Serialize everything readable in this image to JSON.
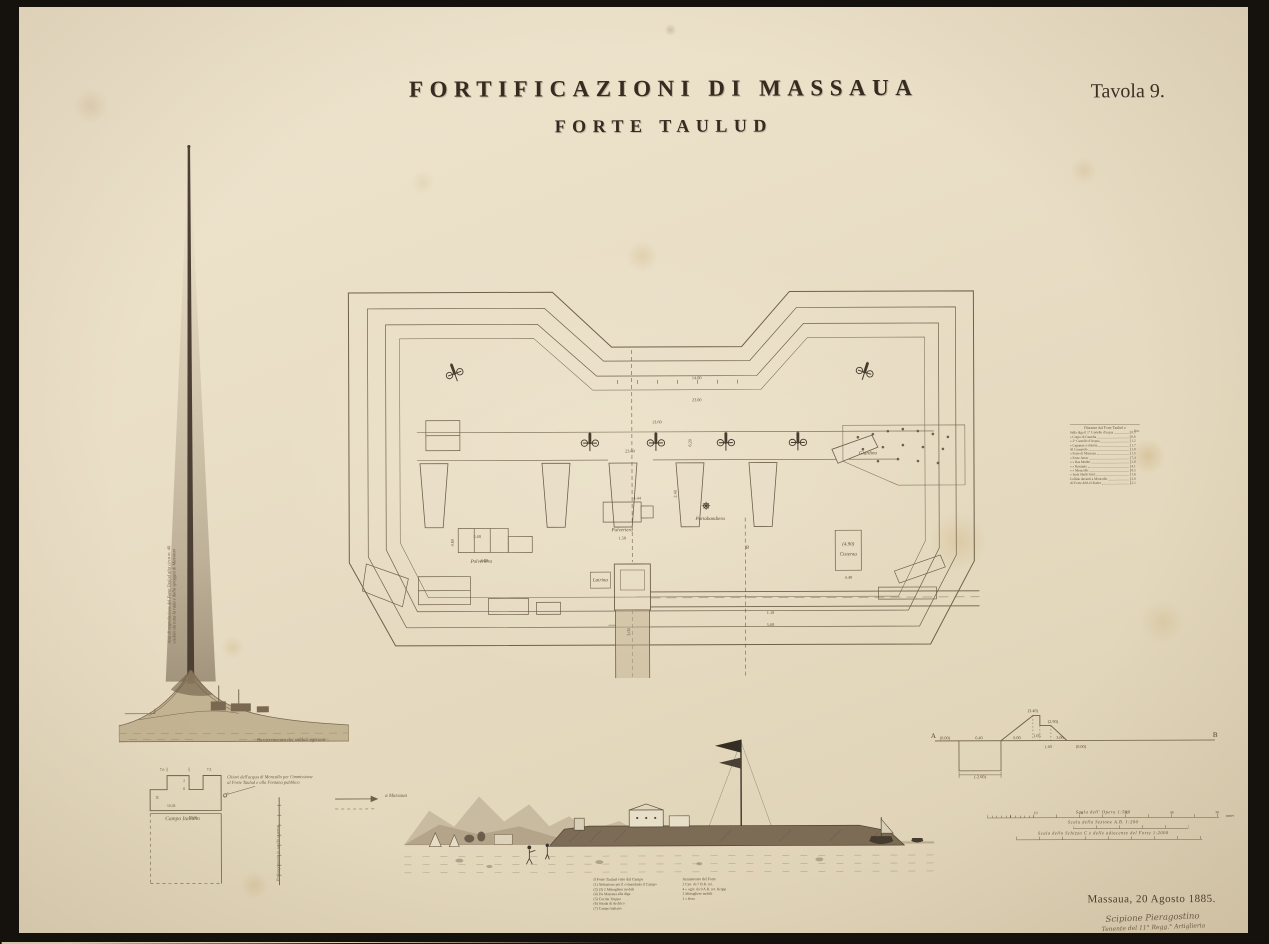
{
  "plate": {
    "title": "FORTIFICAZIONI DI MASSAUA",
    "subtitle": "FORTE TAULUD",
    "tavola": "Tavola 9.",
    "place_date": "Massaua, 20 Agosto 1885.",
    "signature_name": "Scipione Pieragostino",
    "signature_role": "Tenente del 11° Regg.° Artiglieria"
  },
  "colors": {
    "paper": "#e8ddc4",
    "ink": "#352b20",
    "drawing_line": "#6f604a",
    "faded": "#8a7963",
    "backdrop": "#14110d"
  },
  "plan": {
    "labels": [
      {
        "t": "Polveriera",
        "x": 143,
        "y": 281
      },
      {
        "t": "Polveriera",
        "x": 284,
        "y": 250
      },
      {
        "t": "Latrina",
        "x": 262,
        "y": 300
      },
      {
        "t": "(4.90)",
        "x": 510,
        "y": 265
      },
      {
        "t": "Cisterna",
        "x": 510,
        "y": 275
      },
      {
        "t": "Giardino",
        "x": 530,
        "y": 174
      },
      {
        "t": "Portabandiera",
        "x": 372,
        "y": 239
      },
      {
        "t": "B",
        "x": 409,
        "y": 268
      }
    ],
    "dimensions": [
      {
        "t": "14.00",
        "x": 359,
        "y": 98
      },
      {
        "t": "23.00",
        "x": 359,
        "y": 120
      },
      {
        "t": "13.60",
        "x": 319,
        "y": 142
      },
      {
        "t": "23.60",
        "x": 292,
        "y": 171
      },
      {
        "t": "6.20",
        "x": 352,
        "y": 163,
        "r": -90
      },
      {
        "t": "2.40",
        "x": 337,
        "y": 214,
        "r": -90
      },
      {
        "t": "5.60",
        "x": 139,
        "y": 256
      },
      {
        "t": "4.60",
        "x": 114,
        "y": 262,
        "r": -90
      },
      {
        "t": "6.00",
        "x": 146,
        "y": 280
      },
      {
        "t": "1.50",
        "x": 284,
        "y": 258
      },
      {
        "t": "4.44",
        "x": 299,
        "y": 218
      },
      {
        "t": "4.40",
        "x": 510,
        "y": 298
      },
      {
        "t": "3.00",
        "x": 290,
        "y": 352,
        "r": -90
      },
      {
        "t": "1.10",
        "x": 432,
        "y": 333
      },
      {
        "t": "5.60",
        "x": 432,
        "y": 345
      }
    ]
  },
  "mast": {
    "annotation1": "Asta di segnalazione del Forte Taulud alta circa m. 40",
    "annotation2": "visibile da tutta la rada e dalla spiaggia di Massaua",
    "base_label": "Baraccamento dei soldati egiziani"
  },
  "sketch": {
    "note_line1": "Chiavi dell'acqua di Moncullo per l'immissione",
    "note_line2": "al Forte Taulud e alla Fontana pubblica",
    "campo": "Campo Italiano",
    "arrow": "a Massaua",
    "rotated": "Prolungamento in sacchi a terra",
    "dims": [
      {
        "t": "7.0",
        "x": 33,
        "y": 16
      },
      {
        "t": "7.5",
        "x": 80,
        "y": 16
      },
      {
        "t": "2",
        "x": 55,
        "y": 27
      },
      {
        "t": "8",
        "x": 55,
        "y": 35
      },
      {
        "t": "10.28",
        "x": 42,
        "y": 52
      },
      {
        "t": "39.60",
        "x": 64,
        "y": 64
      },
      {
        "t": "10",
        "x": 28,
        "y": 44,
        "r": -90
      },
      {
        "t": "5",
        "x": 98,
        "y": 40,
        "r": -90
      }
    ]
  },
  "legend": {
    "left_title": "Il Forte Taulud visto dal Campo",
    "left_items": [
      "(1)  Abitazione per il comandante il Campo",
      "(2) (3)  2 Mitragliere mobili",
      "(4)  Da Massaua alla diga",
      "(5)  Cucina Truppa",
      "(6)  Strada di Archico",
      "(7)  Campo Italiano"
    ],
    "right_title": "Armamento del Forte",
    "right_items": [
      "2 Can. da 7 B.R. ret.",
      "4  »  ogiv. da 9 A.R. ret. Krupp",
      "2 Mitragliere mobili",
      "1  »  fissa"
    ]
  },
  "profile": {
    "a": "A",
    "b": "B",
    "annotations": [
      {
        "t": "(0.00)",
        "x": 16,
        "y": 37
      },
      {
        "t": "6.40",
        "x": 50,
        "y": 37
      },
      {
        "t": "(-2.00)",
        "x": 51,
        "y": 76
      },
      {
        "t": "6.00",
        "x": 88,
        "y": 37
      },
      {
        "t": "(3.40)",
        "x": 104,
        "y": 10
      },
      {
        "t": "(2.90)",
        "x": 124,
        "y": 21
      },
      {
        "t": "1.05",
        "x": 108,
        "y": 35
      },
      {
        "t": "1.40",
        "x": 119,
        "y": 46
      },
      {
        "t": "3.00",
        "x": 131,
        "y": 37
      },
      {
        "t": "(0.00)",
        "x": 152,
        "y": 46
      }
    ]
  },
  "scales": {
    "s1": "Scala dell' Opera 1:500",
    "s2": "Scala della Sezione A.B. 1:200",
    "s3": "Scala dello Schizzo C e delle adiacenze del Forte 1:2000",
    "unit": "metri",
    "ticks": [
      "10",
      "20",
      "30",
      "40",
      "50"
    ]
  },
  "distances": {
    "title": "Distanze dal Forte Taulud a",
    "unit": "Km.",
    "rows": [
      {
        "label": "Sulla diga il 1° Castello d'acqua",
        "value": "0,3"
      },
      {
        "label": "»  Corpo di Guardia",
        "value": "0,6"
      },
      {
        "label": "»  2° Castello d'Acqua",
        "value": "1,2"
      },
      {
        "label": "»  Capanna a sinistra",
        "value": "1,7"
      },
      {
        "label": "Al Comando",
        "value": "1,0"
      },
      {
        "label": "»  Forte di Massaua",
        "value": "1,5"
      },
      {
        "label": "»  Forte Jerrar",
        "value": "7,4"
      },
      {
        "label": "»  »  Ras Mudur",
        "value": "2,8"
      },
      {
        "label": "»  »  Rotumia",
        "value": "4,1"
      },
      {
        "label": "»  »  Moncullo",
        "value": "8,5"
      },
      {
        "label": "»  Isola Sheik Said",
        "value": "1,6"
      },
      {
        "label": "Colline davanti a Moncullo",
        "value": "2,0"
      },
      {
        "label": "Al Forte Abd-el-Kader",
        "value": "2,1"
      }
    ]
  }
}
